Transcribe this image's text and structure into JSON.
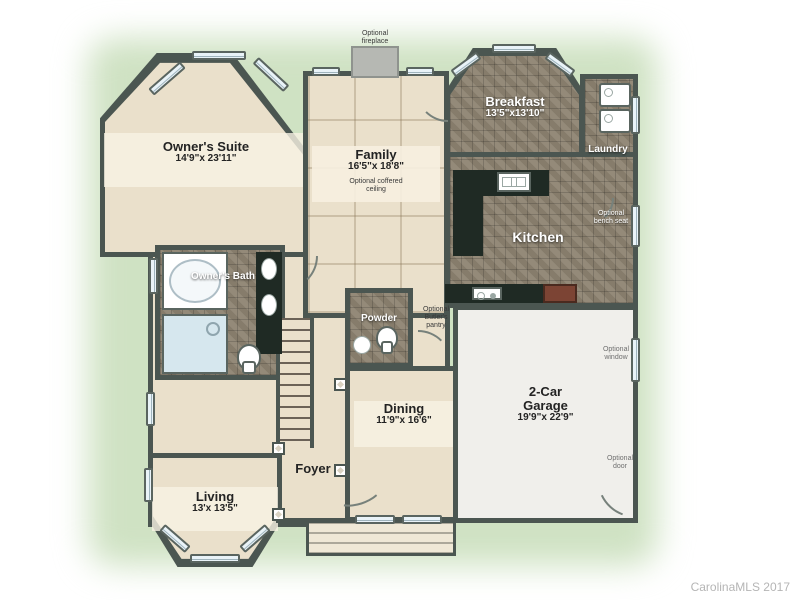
{
  "watermark": "CarolinaMLS 2017",
  "colors": {
    "wall": "#4b5651",
    "floor": "#eae0cb",
    "floor_light": "#f6efdf",
    "tile": "#8d8371",
    "garage": "#f0efeb",
    "island": "#1f2a24",
    "glow": "#cfe2c3",
    "watermark": "#b5b5b5"
  },
  "rooms": {
    "owners_suite": {
      "name": "Owner's Suite",
      "dims": "14'9\"x 23'11\""
    },
    "family": {
      "name": "Family",
      "dims": "16'5\"x 18'8\"",
      "note": "Optional coffered ceiling"
    },
    "breakfast": {
      "name": "Breakfast",
      "dims": "13'5\"x13'10\""
    },
    "laundry": {
      "name": "Laundry"
    },
    "kitchen": {
      "name": "Kitchen"
    },
    "owners_bath": {
      "name": "Owner's Bath"
    },
    "powder": {
      "name": "Powder"
    },
    "dining": {
      "name": "Dining",
      "dims": "11'9\"x 16'6\""
    },
    "garage": {
      "name": "2-Car Garage",
      "dims": "19'9\"x 22'9\""
    },
    "foyer": {
      "name": "Foyer"
    },
    "living": {
      "name": "Living",
      "dims": "13'x 13'5\""
    }
  },
  "notes": {
    "fireplace": "Optional fireplace",
    "bench_seat": "Optional bench seat",
    "butlers_pantry": "Optional Butler's pantry",
    "window": "Optional window",
    "door": "Optional door"
  },
  "icons": {
    "tub": "bathtub-icon",
    "shower": "shower-icon",
    "toilet": "toilet-icon",
    "sink": "sink-icon",
    "washer_dryer": "washer-dryer-icon",
    "range": "range-icon",
    "stairs": "stairs-icon",
    "fireplace": "fireplace-icon",
    "window": "window-icon",
    "door_arc": "door-swing-icon"
  }
}
